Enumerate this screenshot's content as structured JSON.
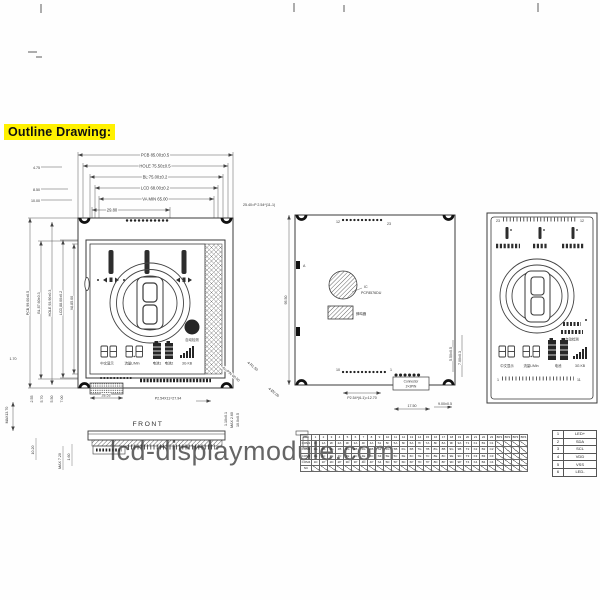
{
  "page": {
    "outline_label": "Outline Drawing:",
    "watermark": "lcd-displaymodule.com",
    "highlight_color": "#fff100",
    "line_color": "#333333"
  },
  "front": {
    "top_dims": [
      "PCB 85.00±0.5",
      "HOLE 75.50±0.5",
      "BL 75.00±0.2",
      "LCD 68.00±0.2",
      "VA MIN 65.00",
      "29.80"
    ],
    "left_offsets": [
      "4.75",
      "8.50",
      "10.00"
    ],
    "top_right_pitch": "25.40=P 2.54*(11-1)",
    "left_dims": [
      "PCB 99.00±0.5",
      "BL 87.60±0.3",
      "HOLE 93.90±0.3",
      "LCD 88.00±0.2",
      "VA 85.00"
    ],
    "gap_dim": "1.70",
    "bottom_offsets": [
      "2.55",
      "5.70",
      "5.50",
      "7.00"
    ],
    "max_thickness": "MAX13.70",
    "pad_width": "28.53",
    "bottom_pitch": "P2.54X11=27.94",
    "diag_pin": "Au-PIN 60.50",
    "diag_radius": "4-R1.50",
    "buzzer_label": "自动检测",
    "icon_labels": [
      "中文显示",
      "流量L/Min",
      "电池1",
      "电池2",
      "3G KB"
    ]
  },
  "side": {
    "caption": "FRONT",
    "left_dims": [
      "10.20",
      "MAX 7.20",
      "1.60"
    ],
    "right_dims": [
      "1.10±0.1",
      "MAX 2.60",
      "10.0±0.5"
    ]
  },
  "back": {
    "height_dim": "95.50",
    "pin_top_first": "12",
    "pin_top_last": "23",
    "comp_a": "A",
    "ic_line1": "IC",
    "ic_line2": "PCF8576DU",
    "buzzer": "蜂鸣器",
    "pin_bottom_first": "10",
    "pin_bottom_last": "1",
    "connector_line1": "Connector",
    "connector_line2": "2×3PIN",
    "pitch": "P2.54*(6-1)=12.70",
    "dim_17_5": "17.50",
    "dim_9": "9.00±0.5",
    "dim_5_5": "5.50±0.5",
    "dim_7": "7.00±0.3",
    "diag_hole": "4-Ø2.00"
  },
  "lcd": {
    "pin_top_left": "23",
    "pin_top_right": "12",
    "pin_bottom_left": "1",
    "pin_bottom_right": "11",
    "side_label": "自动检测",
    "bottom_labels": [
      "中文显示",
      "流量L/Min",
      "电池",
      "3G KB"
    ]
  },
  "segment_table": {
    "header": [
      "PIN",
      "1",
      "2",
      "3",
      "4",
      "5",
      "6",
      "7",
      "8",
      "9",
      "10",
      "11",
      "12",
      "13",
      "14",
      "15",
      "16",
      "17",
      "18",
      "19",
      "20",
      "21",
      "22",
      "23",
      "BP1",
      "BP2",
      "BP3",
      "BP4"
    ],
    "rows": [
      {
        "label": "COM1",
        "cells": [
          "1F",
          "1A",
          "2F",
          "2A",
          "3F",
          "3A",
          "4F",
          "4A",
          "S1",
          "5F",
          "5A",
          "6F",
          "6A",
          "7F",
          "7A",
          "8F",
          "8A",
          "9F",
          "9A",
          "T1",
          "K1",
          "B1",
          "C1",
          "/",
          "/",
          "/",
          "/"
        ]
      },
      {
        "label": "COM2",
        "cells": [
          "1G",
          "1B",
          "2G",
          "2B",
          "3G",
          "3B",
          "4G",
          "4B",
          "S2",
          "5G",
          "5B",
          "6G",
          "6B",
          "7G",
          "7B",
          "8G",
          "8B",
          "9G",
          "9B",
          "T2",
          "K2",
          "B2",
          "C2",
          "/",
          "/",
          "/",
          "/"
        ]
      },
      {
        "label": "COM3",
        "cells": [
          "1E",
          "1C",
          "2E",
          "2C",
          "3E",
          "3C",
          "4E",
          "4C",
          "S3",
          "5E",
          "5C",
          "6E",
          "6C",
          "7E",
          "7C",
          "8E",
          "8C",
          "9E",
          "9C",
          "T3",
          "K3",
          "B3",
          "C3",
          "/",
          "/",
          "/",
          "/"
        ]
      },
      {
        "label": "COM4",
        "cells": [
          "1D",
          "1P",
          "2D",
          "2P",
          "3D",
          "3P",
          "4D",
          "4P",
          "S4",
          "5D",
          "5P",
          "6D",
          "6P",
          "7D",
          "7P",
          "8D",
          "8P",
          "9D",
          "9P",
          "T4",
          "K4",
          "B4",
          "C4",
          "/",
          "/",
          "/",
          "/"
        ]
      },
      {
        "label": "NC",
        "cells": [
          "/",
          "/",
          "/",
          "/",
          "/",
          "/",
          "/",
          "/",
          "/",
          "/",
          "/",
          "/",
          "/",
          "/",
          "/",
          "/",
          "/",
          "/",
          "/",
          "/",
          "/",
          "/",
          "/",
          "/",
          "/",
          "/",
          "/"
        ]
      }
    ]
  },
  "pin_table": {
    "rows": [
      [
        "1",
        "LED+"
      ],
      [
        "2",
        "SDA"
      ],
      [
        "3",
        "SCL"
      ],
      [
        "4",
        "VDD"
      ],
      [
        "5",
        "VSS"
      ],
      [
        "6",
        "LED-"
      ]
    ]
  }
}
